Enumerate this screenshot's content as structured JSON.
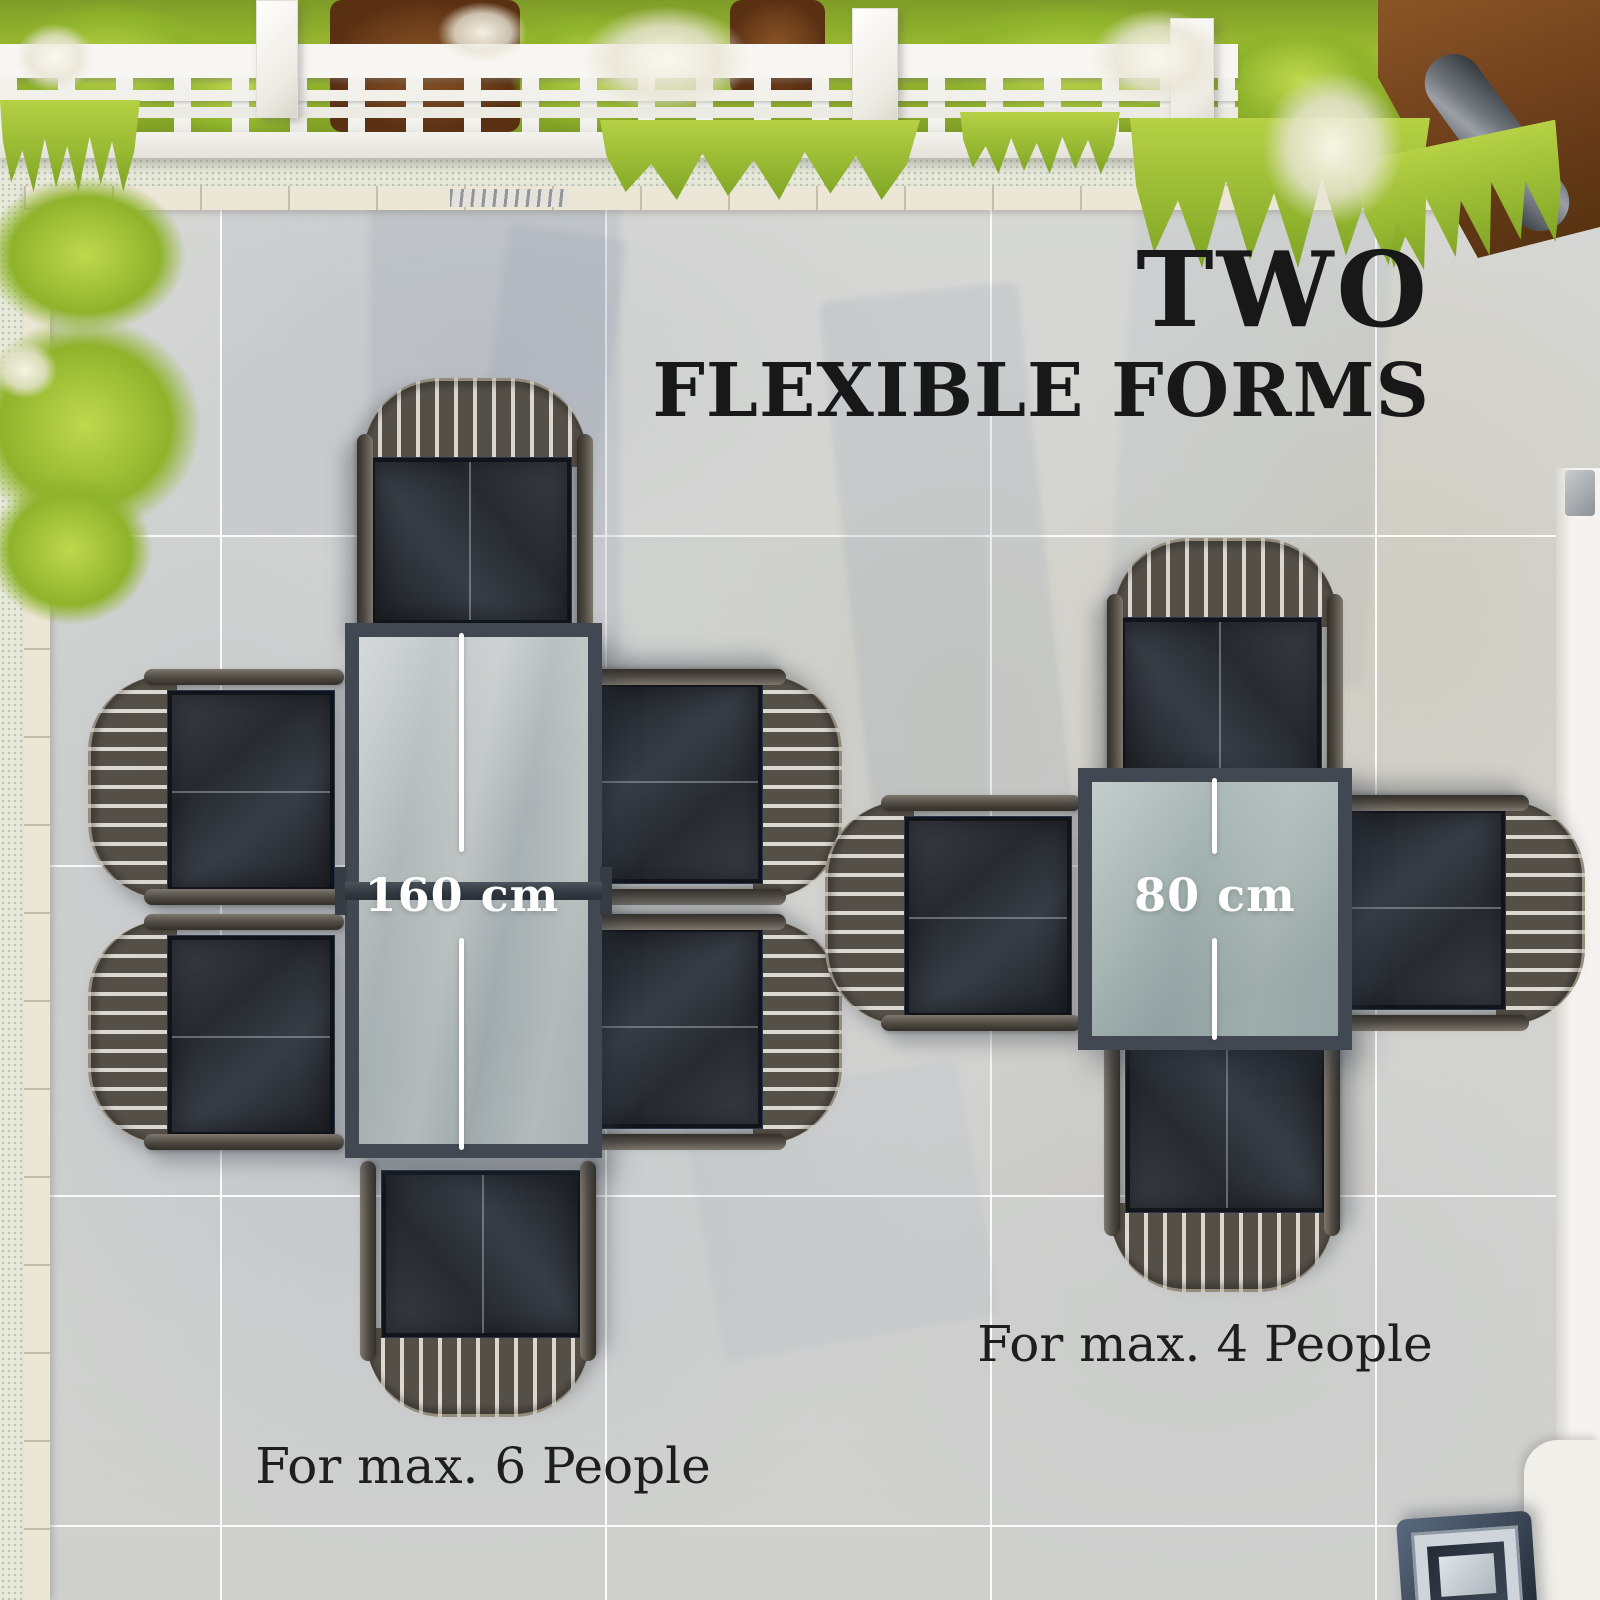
{
  "title": {
    "line1": "TWO",
    "line2": "FLEXIBLE FORMS"
  },
  "sets": [
    {
      "name": "rectangular-table-set",
      "table_shape": "rectangular",
      "dimension_label": "160 cm",
      "caption": "For max. 6 People",
      "seats": 6
    },
    {
      "name": "square-table-set",
      "table_shape": "square",
      "dimension_label": "80 cm",
      "caption": "For max. 4 People",
      "seats": 4
    }
  ],
  "colors": {
    "title_text": "#181818",
    "caption_text": "#1e1e1e",
    "dimension_text": "#ffffff",
    "table_frame": "#414851",
    "table_glass": "#b7bfc0",
    "chair_seat": "#30343a",
    "chair_slats": "#514c44",
    "metal_arm": "#4a463f",
    "floor_tile": "#d5d6d4",
    "grout_line": "#ffffff",
    "pergola_white": "#f6f5f2",
    "grass_green": "#a2c132",
    "soil_brown": "#7a4a26"
  }
}
